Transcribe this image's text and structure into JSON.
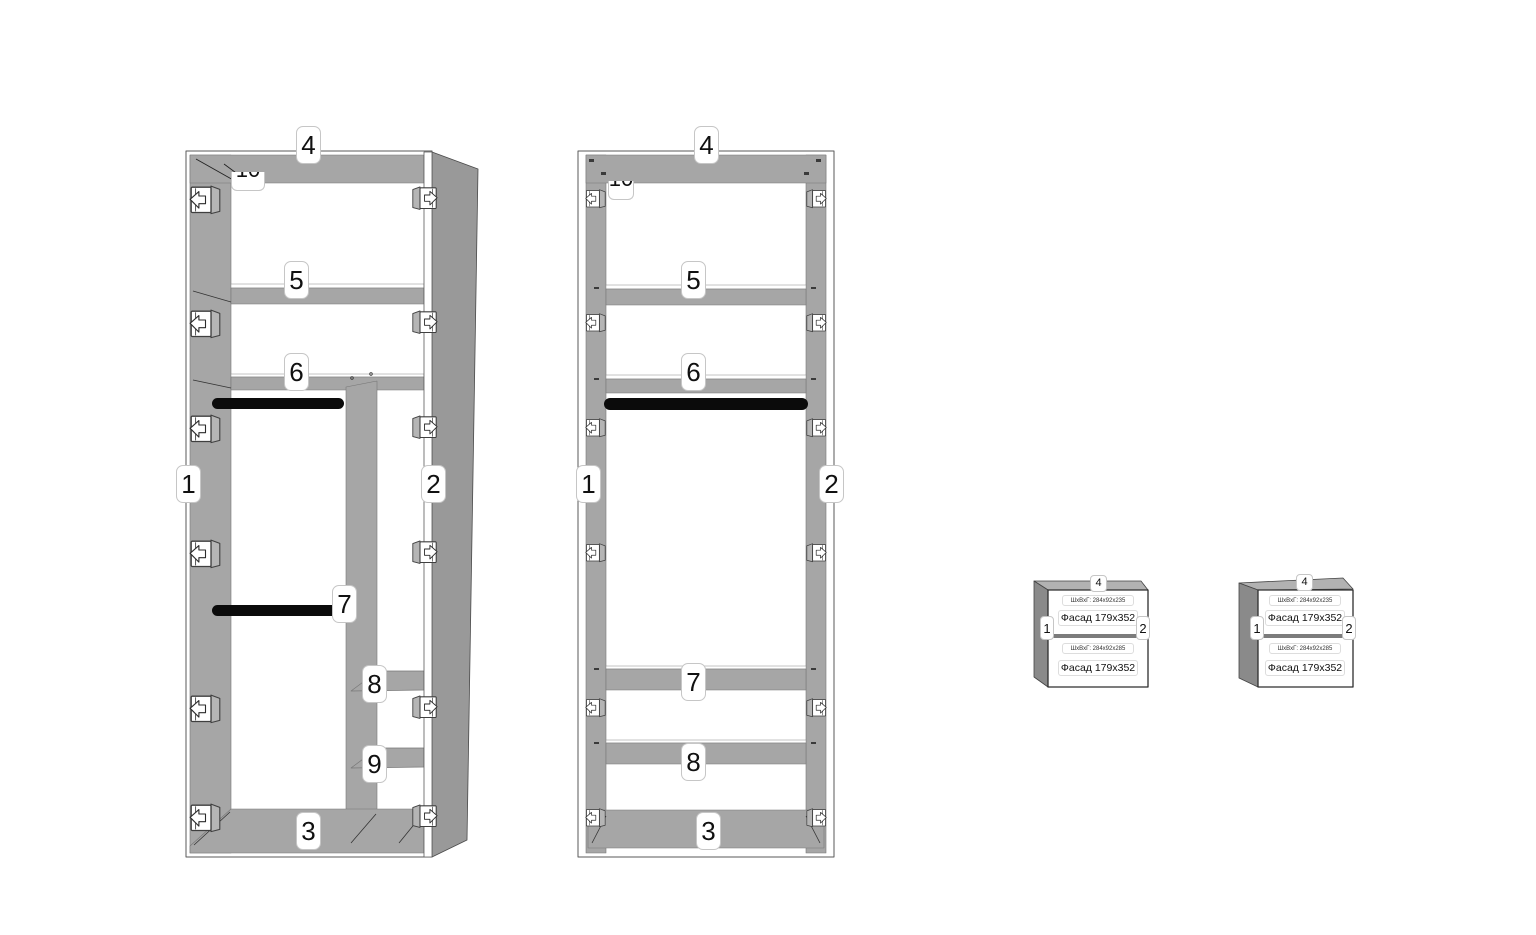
{
  "parts": {
    "side_left": "1",
    "side_right": "2",
    "bottom": "3",
    "top": "4",
    "shelf_5": "5",
    "shelf_6": "6",
    "part_7": "7",
    "part_8": "8",
    "part_9": "9",
    "part_10": "10"
  },
  "drawer_unit": {
    "top": "4",
    "side_left": "1",
    "side_right": "2",
    "upper_drawer": {
      "dimensions": "ШхВхГ: 284x92x235",
      "facade": "Фасад 179x352"
    },
    "lower_drawer": {
      "dimensions": "ШхВхГ: 284x92x285",
      "facade": "Фасад 179x352"
    }
  },
  "colors": {
    "panel_gray": "#a6a6a6",
    "panel_side_gray": "#999999",
    "drawer_side_gray": "#8a8a8a",
    "drawer_top_gray": "#b2b2b2",
    "rod_black": "#0b0b0b",
    "background": "#ffffff"
  }
}
